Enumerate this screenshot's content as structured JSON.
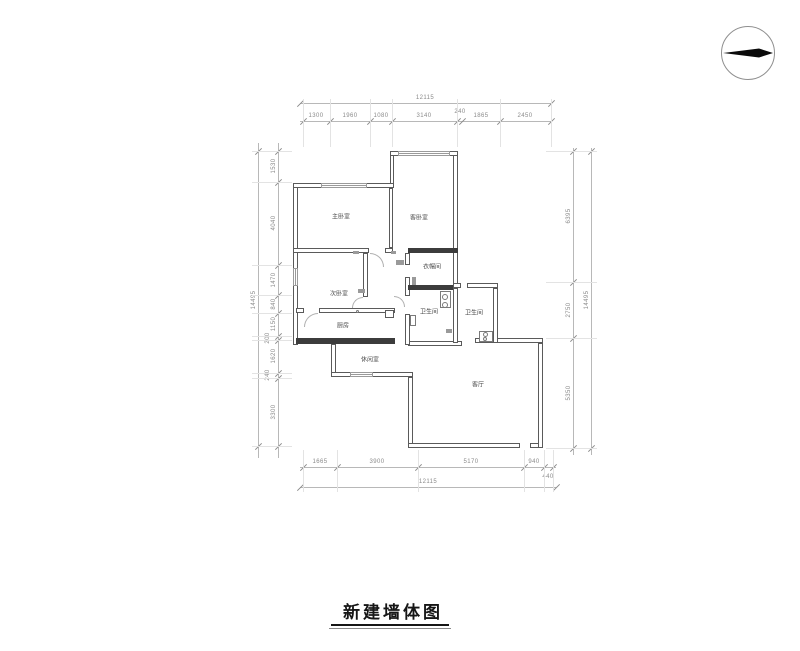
{
  "title": {
    "text": "新建墙体图"
  },
  "compass": {
    "icon": "north-indicator"
  },
  "rooms": [
    {
      "label": "主卧室"
    },
    {
      "label": "客卧室"
    },
    {
      "label": "次卧室"
    },
    {
      "label": "衣帽间"
    },
    {
      "label": "卫生间"
    },
    {
      "label": "卫生间"
    },
    {
      "label": "厨房"
    },
    {
      "label": "休闲室"
    },
    {
      "label": "客厅"
    }
  ],
  "dimensions": {
    "top": {
      "total": "12115",
      "segments": [
        "1300",
        "1960",
        "1080",
        "3140",
        "240",
        "1865",
        "2450"
      ]
    },
    "bottom": {
      "total": "12115",
      "segments": [
        "1665",
        "3900",
        "5170",
        "940",
        "440"
      ]
    },
    "left": {
      "total": "14495",
      "segments": [
        "1530",
        "4040",
        "1470",
        "840",
        "1150",
        "200",
        "1620",
        "240",
        "3300"
      ]
    },
    "right": {
      "total": "14495",
      "segments": [
        "6395",
        "2750",
        "5350"
      ]
    }
  },
  "colors": {
    "wall": "#5a5a5a",
    "new_wall": "#3c3c3c",
    "dimension": "#8a8a8a",
    "needle": "#0a0a0a"
  }
}
